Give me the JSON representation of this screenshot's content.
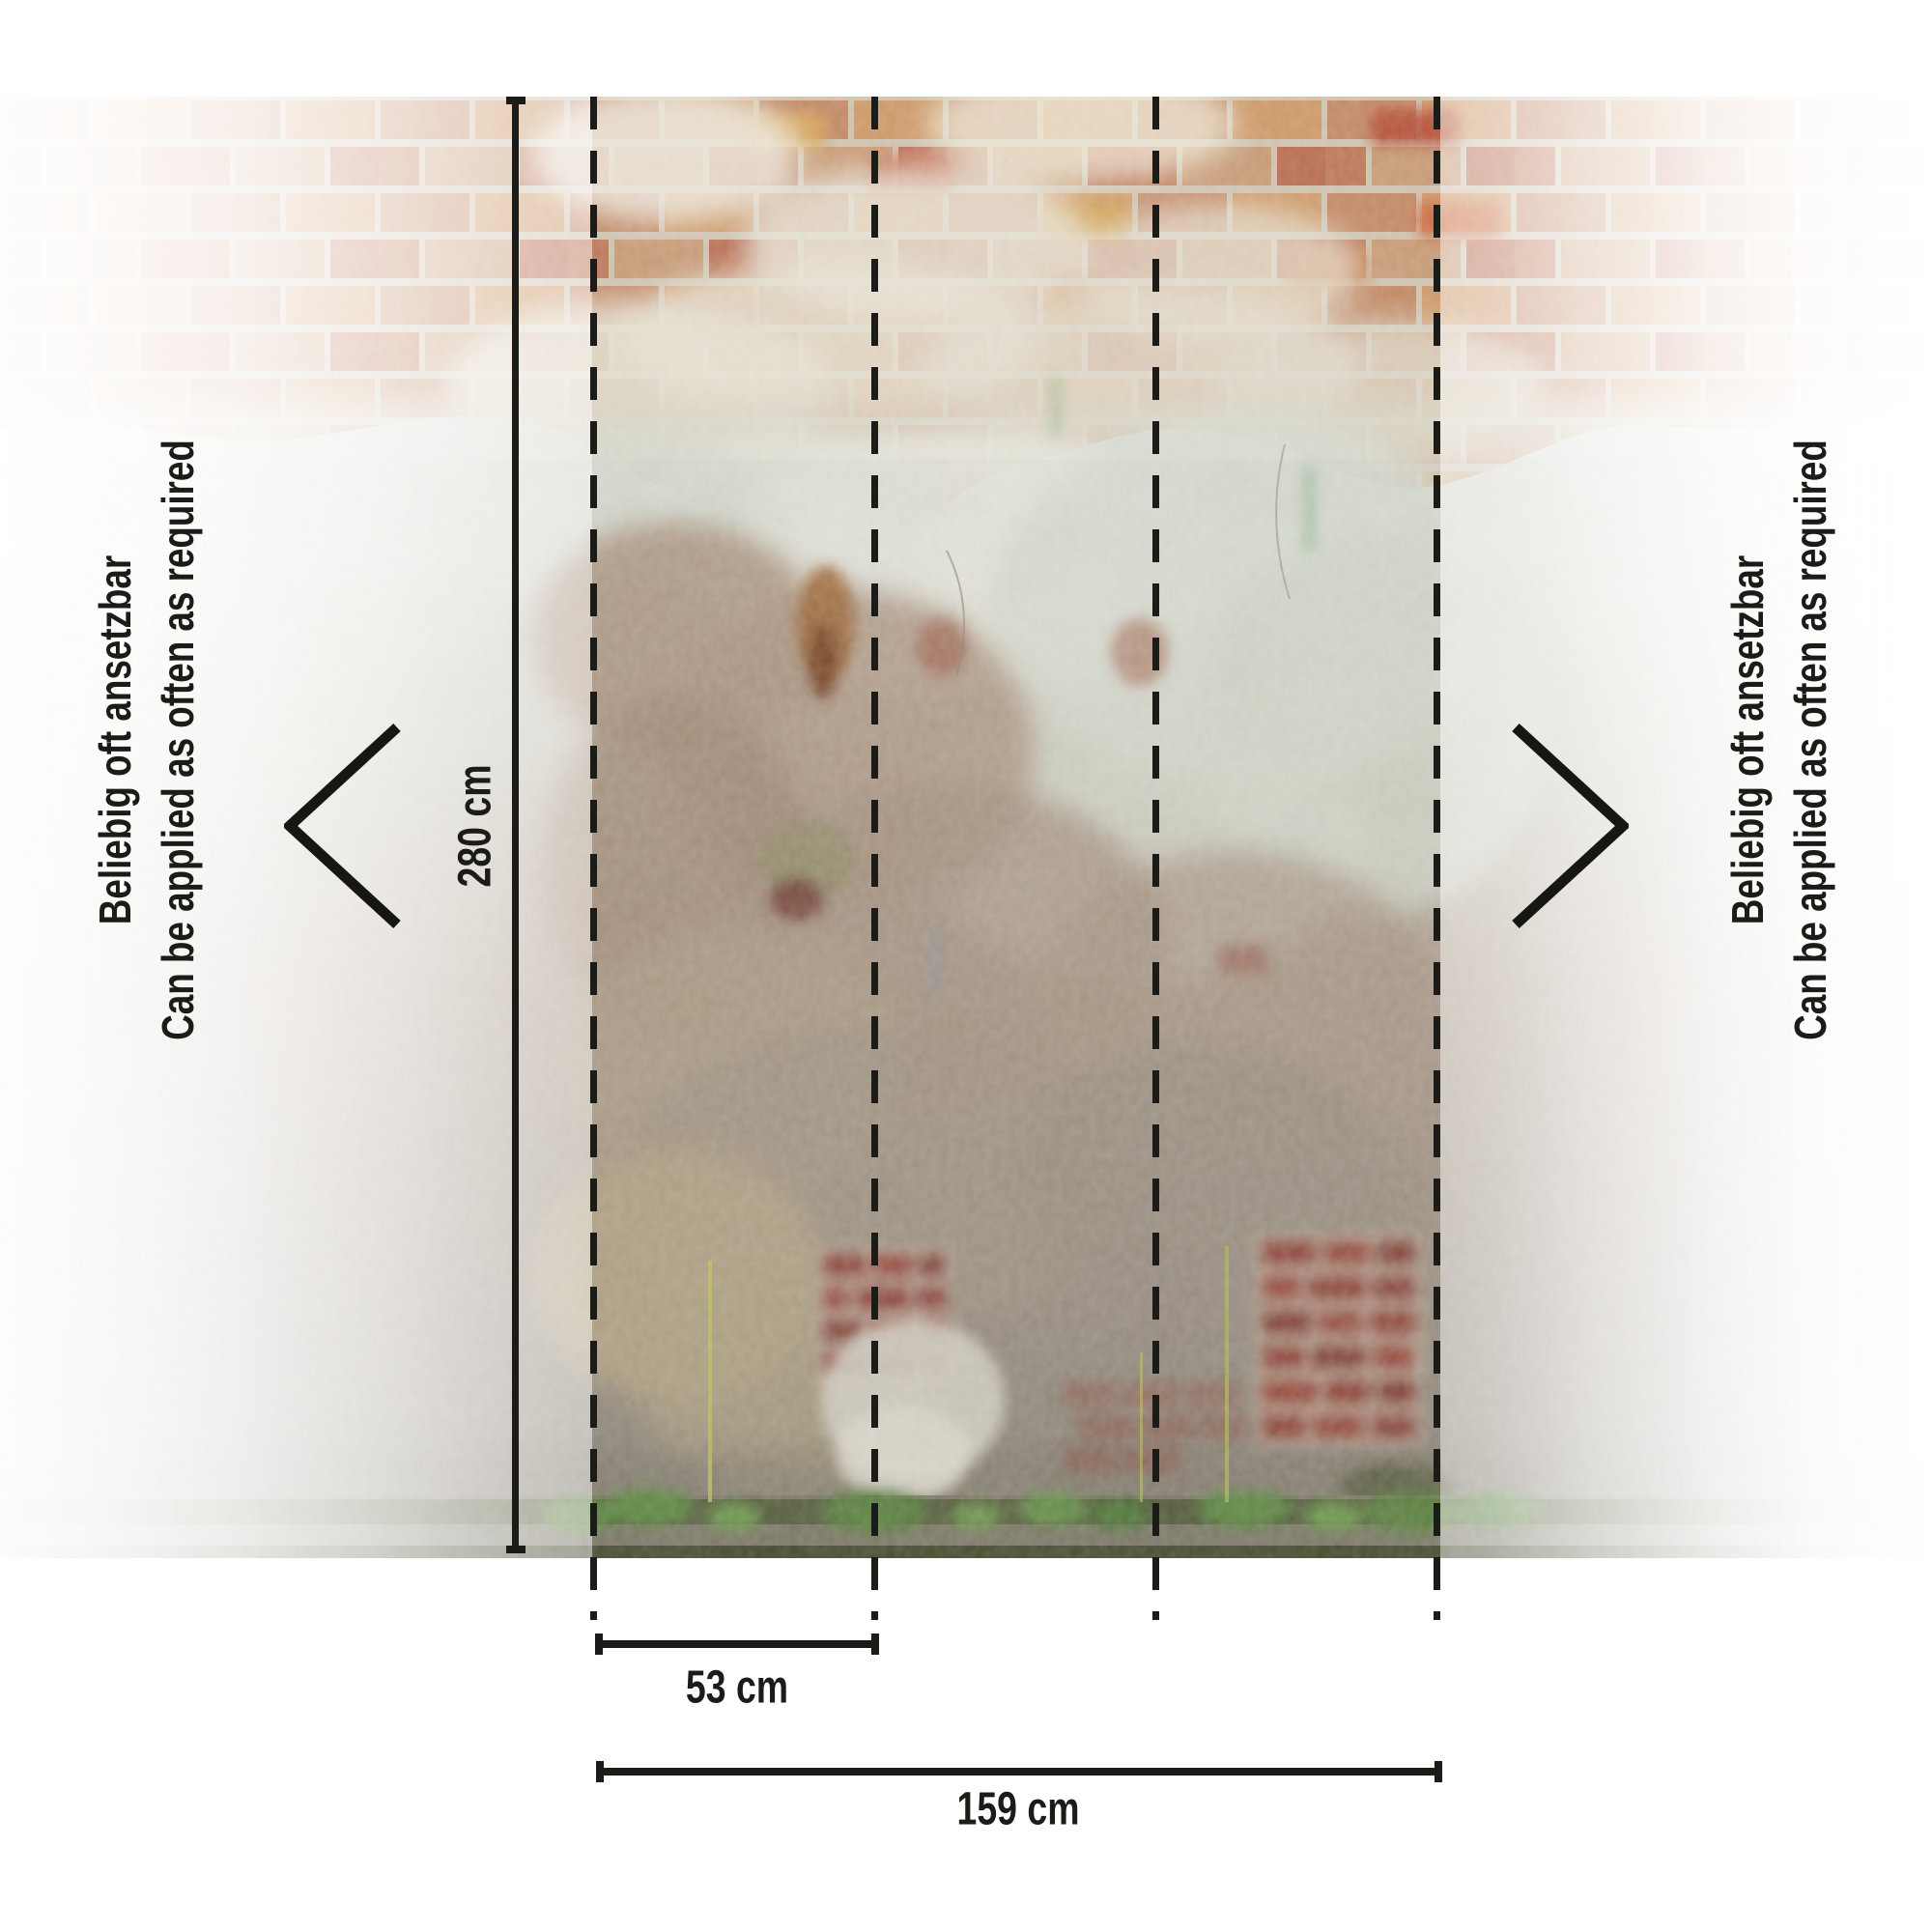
{
  "diagram": {
    "labels": {
      "de": "Beliebig oft ansetzbar",
      "en": "Can be applied as often as required"
    },
    "dimensions": {
      "height": "280 cm",
      "strip_width": "53 cm",
      "total_width": "159 cm"
    },
    "strips": {
      "count": 3,
      "seam_count": 4
    },
    "icons": [
      "chevron-left-icon",
      "chevron-right-icon"
    ]
  },
  "colors": {
    "annotation": "#1b1b18",
    "background": "#ffffff",
    "brick": "#c28a68",
    "brick-red": "#8e4437",
    "mortar": "#cfc2b0",
    "plaster-light": "#d8dbd2",
    "plaster-brown": "#ab998b",
    "grass": "#55803c"
  }
}
